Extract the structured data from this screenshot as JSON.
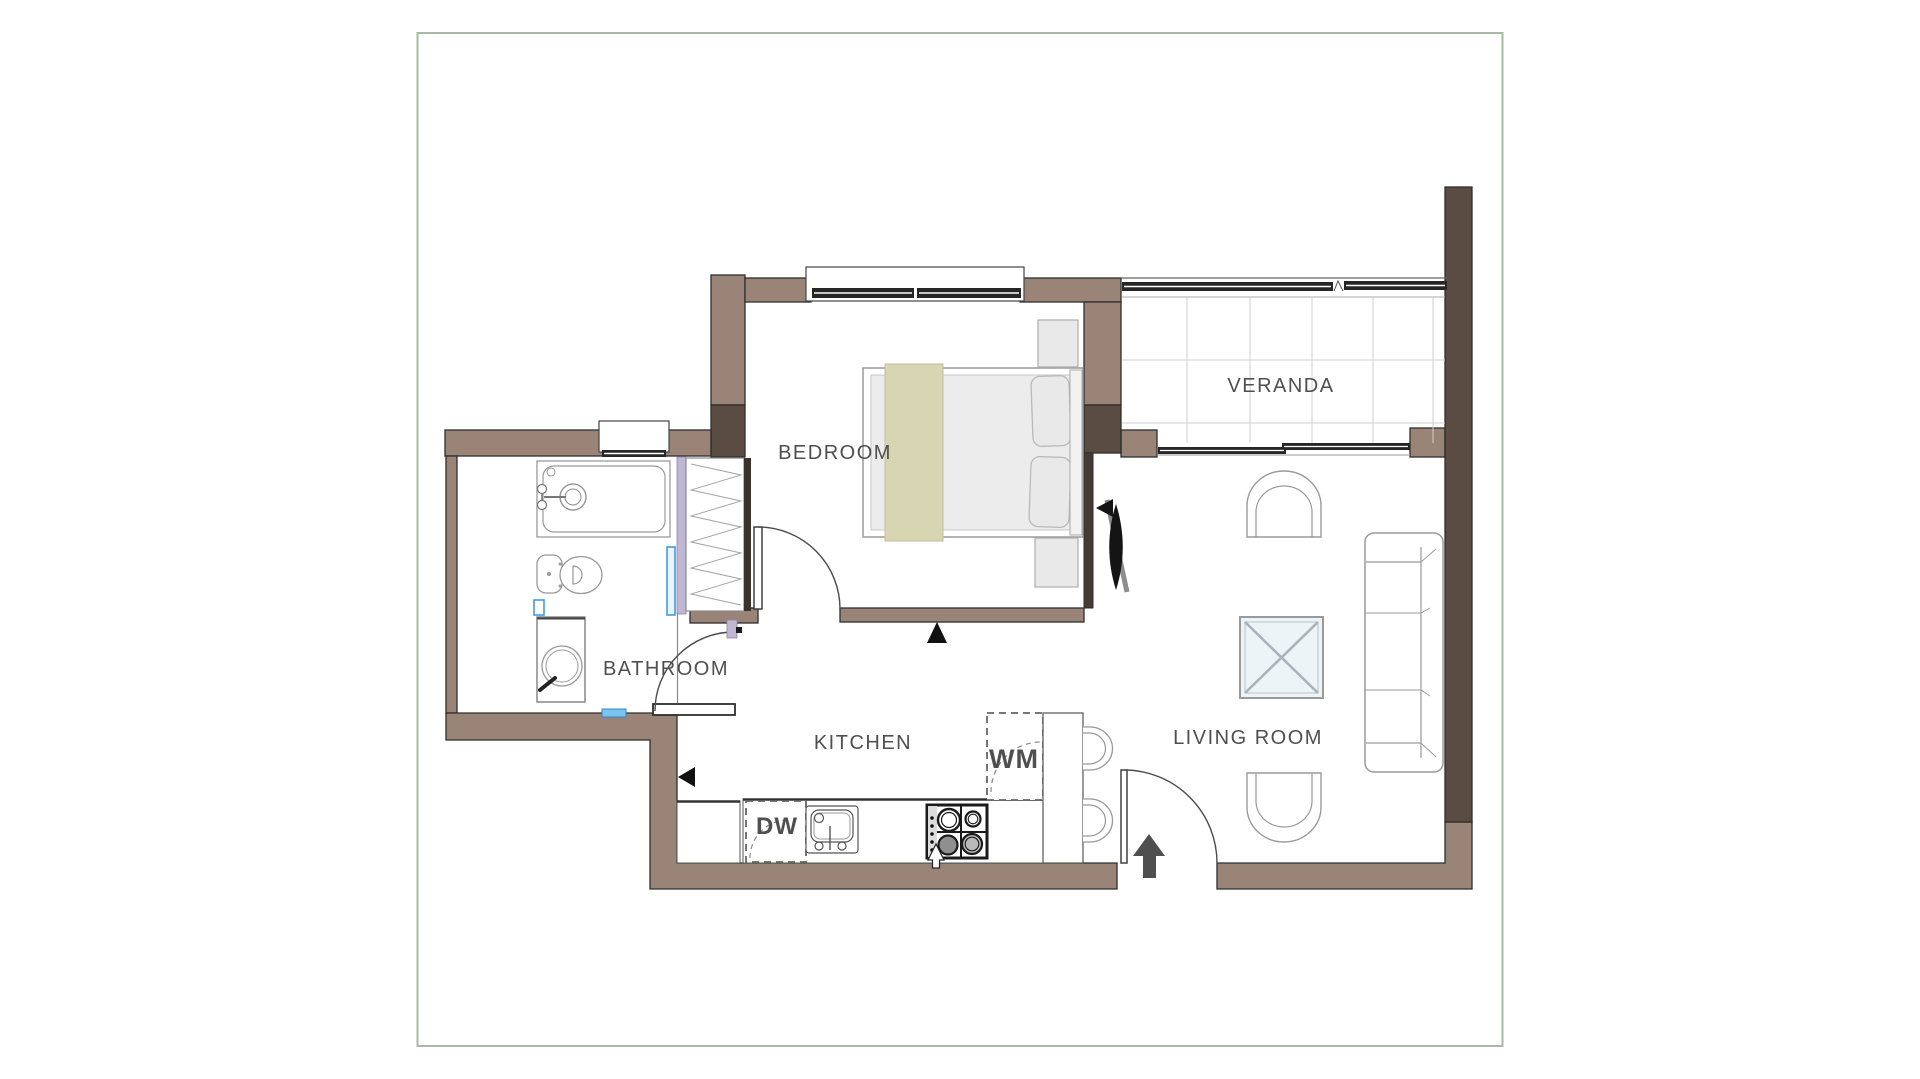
{
  "colors": {
    "border_green": "#a8baa5",
    "wall_light": "#9a8377",
    "wall_dark": "#5a4c42",
    "wall_thin_dark": "#453b33",
    "jamb_lavender": "#c0b8d2",
    "accent_blue": "#3f9de0",
    "glass_dark": "#262626",
    "blanket_olive": "#d8d5b2",
    "furniture_outline": "#9a9a9a",
    "table_fill": "#edf4f7",
    "label_gray": "#4f4f4f"
  },
  "rooms": [
    {
      "id": "bedroom",
      "label": "BEDROOM"
    },
    {
      "id": "veranda",
      "label": "VERANDA"
    },
    {
      "id": "bathroom",
      "label": "BATHROOM"
    },
    {
      "id": "kitchen",
      "label": "KITCHEN"
    },
    {
      "id": "living_room",
      "label": "LIVING ROOM"
    }
  ],
  "appliances": [
    {
      "id": "washing_machine",
      "label": "WM"
    },
    {
      "id": "dishwasher",
      "label": "DW"
    }
  ]
}
